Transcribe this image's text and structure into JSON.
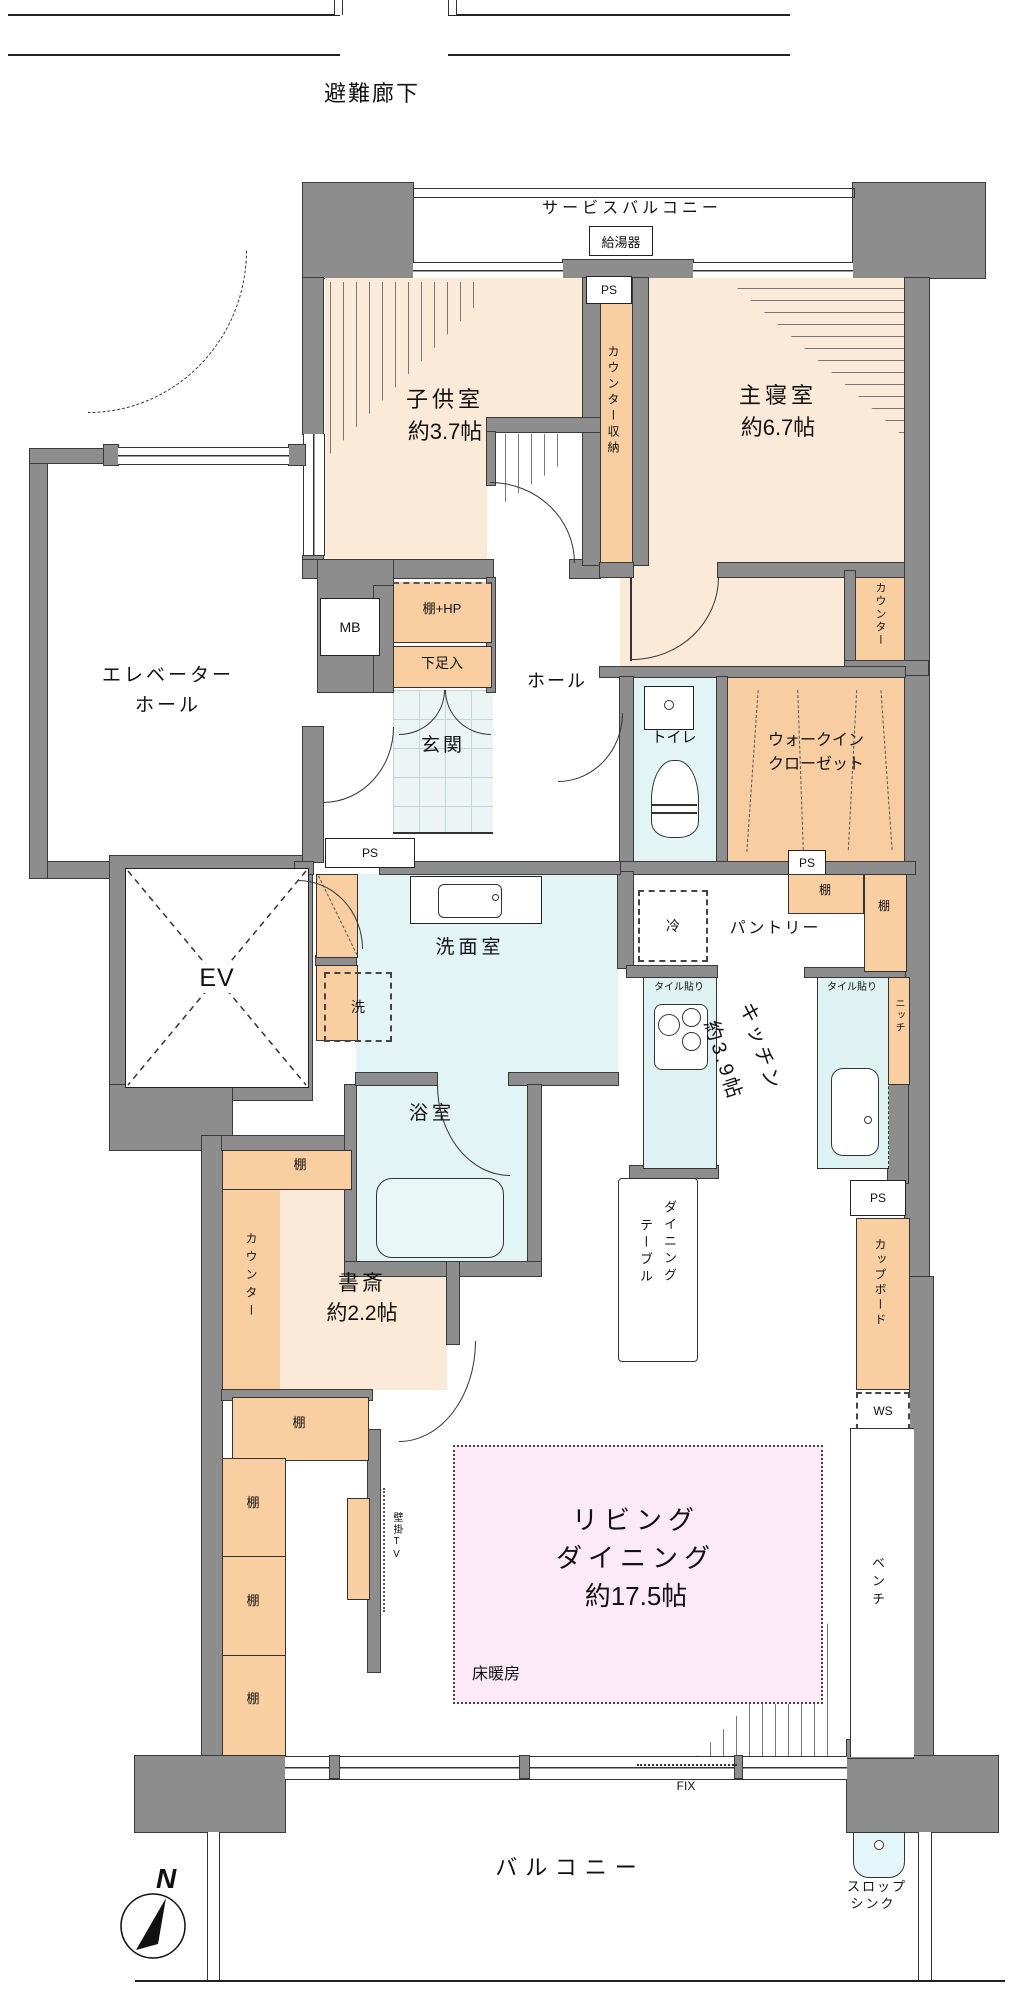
{
  "floor_plan": {
    "colors": {
      "wall": "#8d8d8d",
      "room_pink": "#fcead9",
      "storage_orange": "#f9cfa2",
      "wet_area_blue": "#e2f4f4",
      "entrance_tile": "#edf4f4",
      "floor_heating_pink": "#fcebf7",
      "line": "#2f2f2f"
    },
    "labels": {
      "escape_corridor": "避難廊下",
      "service_balcony": "サービスバルコニー",
      "water_heater": "給湯器",
      "ps": "PS",
      "kids_room": "子供室",
      "kids_room_size": "約3.7帖",
      "counter_storage": "カウンター収納",
      "master_bedroom": "主寝室",
      "master_bedroom_size": "約6.7帖",
      "counter": "カウンター",
      "mb": "MB",
      "shelf_hp": "棚+HP",
      "shoe_box": "下足入",
      "entrance": "玄関",
      "hall": "ホール",
      "elevator_hall_line1": "エレベーター",
      "elevator_hall_line2": "ホール",
      "toilet": "トイレ",
      "wic_line1": "ウォークイン",
      "wic_line2": "クローゼット",
      "elevator": "EV",
      "powder_room": "洗面室",
      "washer": "洗",
      "bathroom": "浴室",
      "refrigerator": "冷",
      "pantry": "パントリー",
      "shelf": "棚",
      "kitchen": "キッチン",
      "kitchen_size": "約3.9帖",
      "tiled": "タイル貼り",
      "niche": "ニッチ",
      "cupboard": "カップボード",
      "ws": "WS",
      "dining_table_line1": "ダイニング",
      "dining_table_line2": "テーブル",
      "living_line1": "リビング",
      "living_line2": "ダイニング",
      "living_size": "約17.5帖",
      "floor_heating": "床暖房",
      "wall_tv": "壁掛TV",
      "bench": "ベンチ",
      "fix": "FIX",
      "balcony": "バルコニー",
      "slop_sink_line1": "スロップ",
      "slop_sink_line2": "シンク",
      "north": "N"
    }
  }
}
